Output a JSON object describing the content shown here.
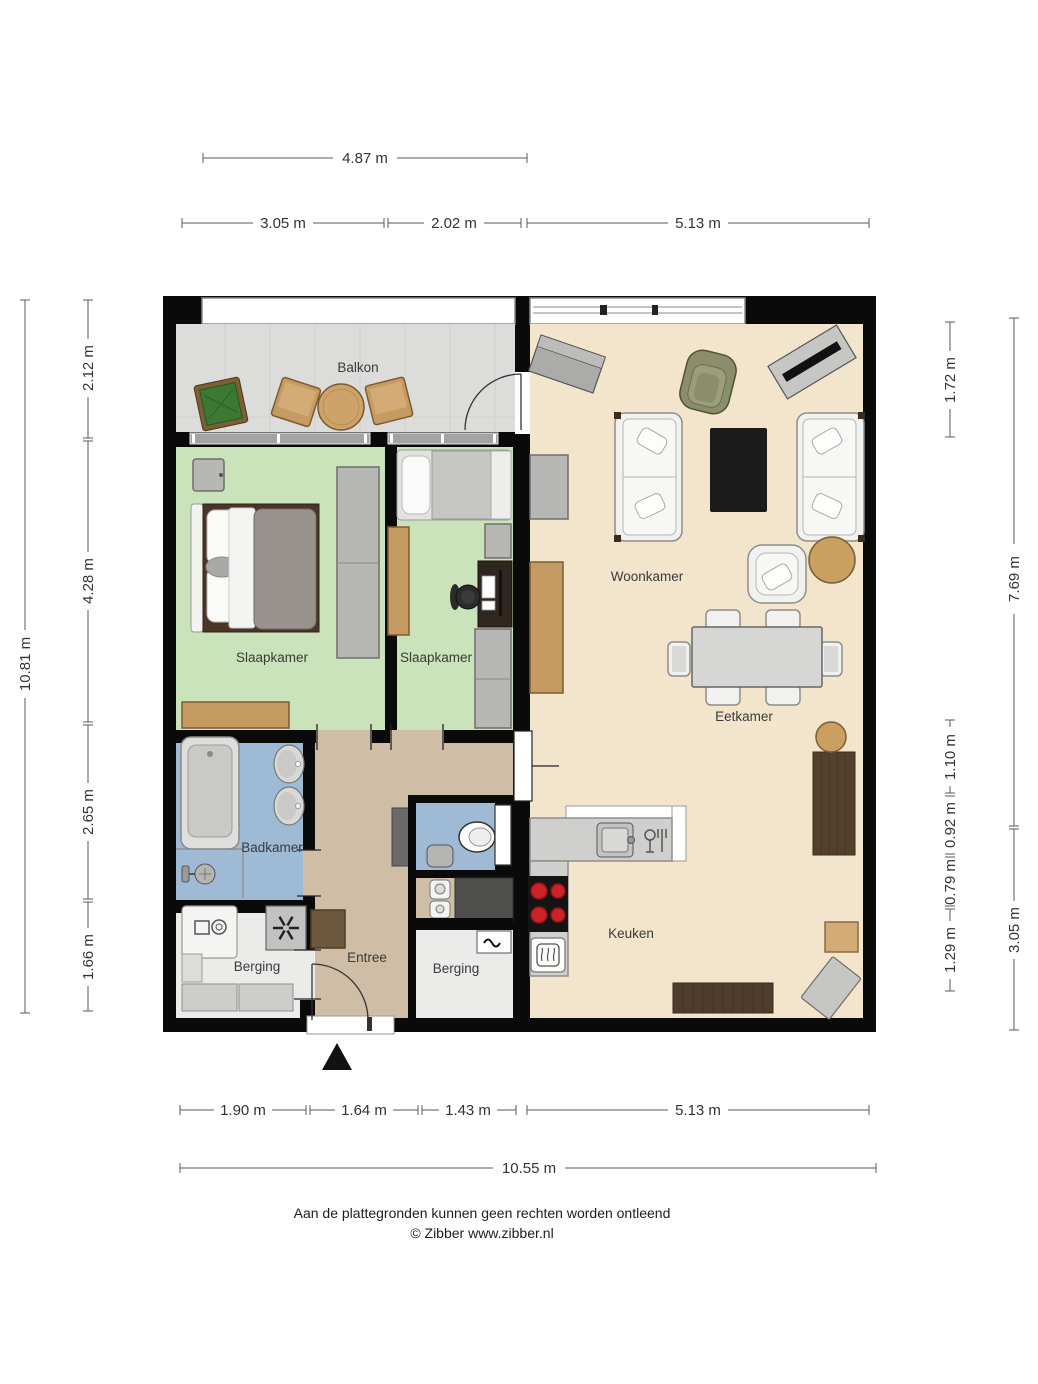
{
  "colors": {
    "balcony_floor": "#dcdcda",
    "bedroom_floor": "#cbe3ba",
    "living_floor": "#f3e5cb",
    "entree_floor": "#cfbda6",
    "bath_floor": "#9fbad5",
    "storage_floor": "#ebebe9"
  },
  "rooms": {
    "balkon": {
      "label": "Balkon"
    },
    "slaapkamer_1": {
      "label": "Slaapkamer"
    },
    "slaapkamer_2": {
      "label": "Slaapkamer"
    },
    "woonkamer": {
      "label": "Woonkamer"
    },
    "eetkamer": {
      "label": "Eetkamer"
    },
    "badkamer": {
      "label": "Badkamer"
    },
    "berging_1": {
      "label": "Berging"
    },
    "entree": {
      "label": "Entree"
    },
    "berging_2": {
      "label": "Berging"
    },
    "keuken": {
      "label": "Keuken"
    }
  },
  "dimensions": {
    "top": {
      "width_upper": "4.87 m",
      "segment_1": "3.05 m",
      "segment_2": "2.02 m",
      "segment_3": "5.13 m"
    },
    "left": {
      "total": "10.81 m",
      "segment_1": "2.12 m",
      "segment_2": "4.28 m",
      "segment_3": "2.65 m",
      "segment_4": "1.66 m"
    },
    "right": {
      "outer_1": "7.69 m",
      "outer_2": "3.05 m",
      "segment_1": "1.72 m",
      "segment_2": "1.10 m",
      "segment_3": "0.92 m",
      "segment_4": "0.79 m",
      "segment_5": "1.29 m"
    },
    "bottom": {
      "segment_1": "1.90 m",
      "segment_2": "1.64 m",
      "segment_3": "1.43 m",
      "segment_4": "5.13 m",
      "total": "10.55 m"
    }
  },
  "footer": {
    "disclaimer": "Aan de plattegronden kunnen geen rechten worden ontleend",
    "copyright": "© Zibber www.zibber.nl"
  }
}
